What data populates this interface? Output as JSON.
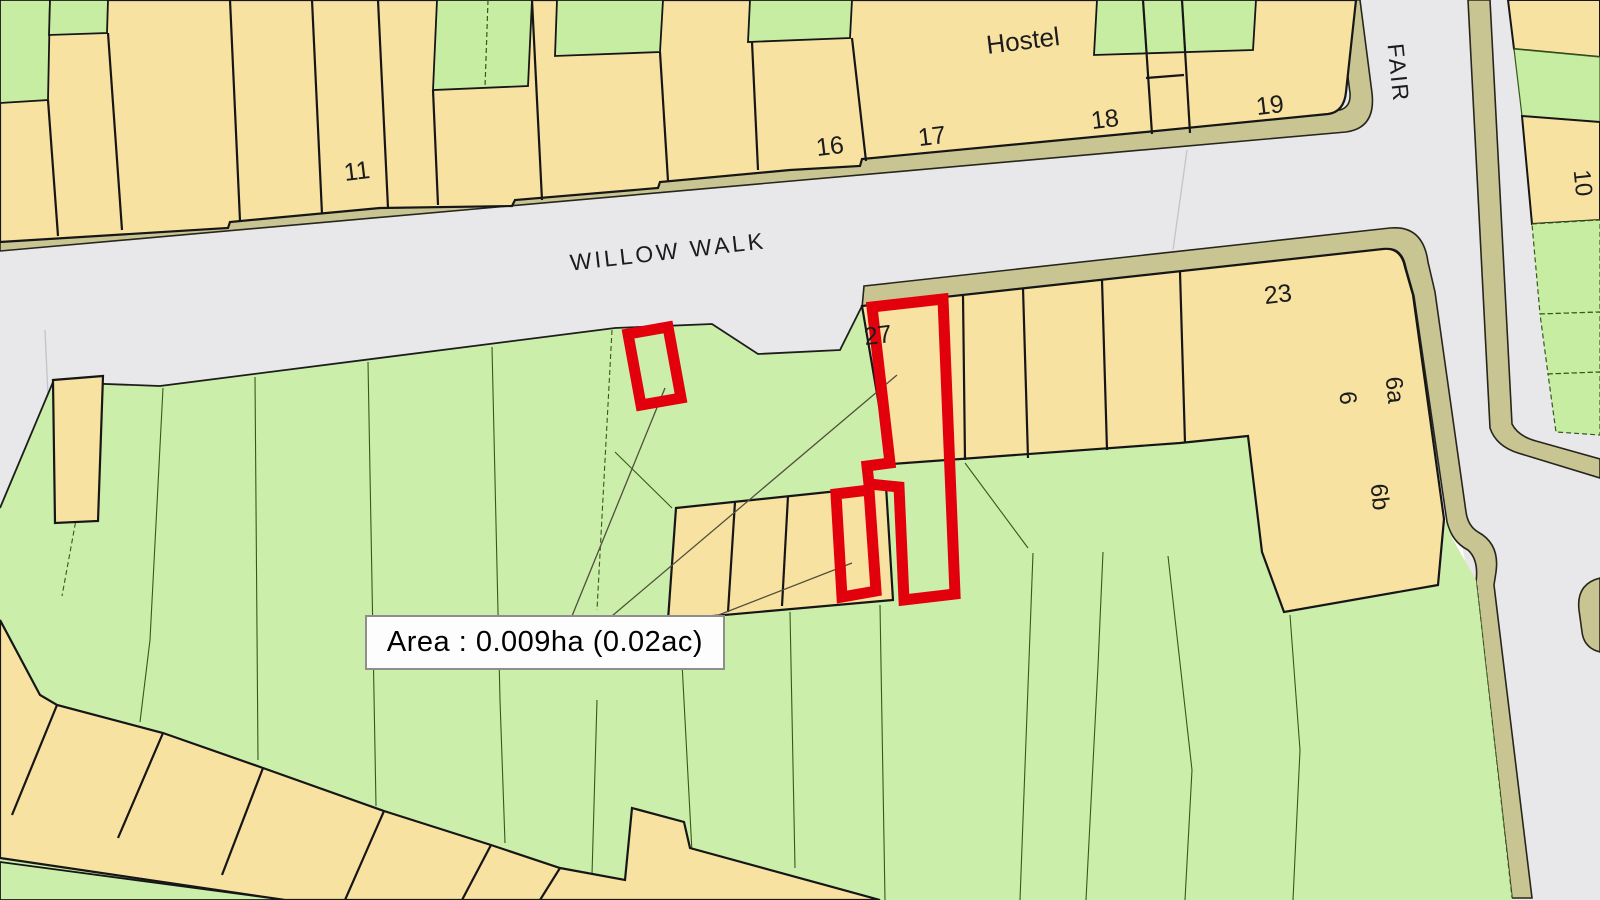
{
  "map": {
    "description": "Ordnance-survey style cadastral site plan",
    "streets": [
      {
        "name": "WILLOW WALK"
      },
      {
        "name": "FAIR"
      }
    ],
    "area_label": {
      "text": "Area : 0.009ha (0.02ac)"
    },
    "highlight": {
      "plot_number": "27",
      "outline_color": "#e2000c",
      "outlined_plots": 3
    },
    "colors": {
      "road": "#e8e8ea",
      "road_edge": "#c9c593",
      "building": "#f8e2a2",
      "plot_green": "#cbeeaa",
      "outline": "#161616",
      "plot_line": "#35591c",
      "highlight_red": "#e2000c",
      "label_box_bg": "#fdfdfd",
      "label_box_border": "#8e8e8e"
    },
    "labels": [
      {
        "name": "label-11",
        "text": "11",
        "x": 357,
        "y": 172,
        "size": 25,
        "rot": -7
      },
      {
        "name": "label-16",
        "text": "16",
        "x": 830,
        "y": 147,
        "size": 25,
        "rot": -7
      },
      {
        "name": "label-17",
        "text": "17",
        "x": 932,
        "y": 137,
        "size": 25,
        "rot": -7
      },
      {
        "name": "label-hostel",
        "text": "Hostel",
        "x": 1023,
        "y": 41,
        "size": 26,
        "rot": -7
      },
      {
        "name": "label-18",
        "text": "18",
        "x": 1105,
        "y": 120,
        "size": 25,
        "rot": -7
      },
      {
        "name": "label-19",
        "text": "19",
        "x": 1270,
        "y": 106,
        "size": 25,
        "rot": -7
      },
      {
        "name": "label-23",
        "text": "23",
        "x": 1278,
        "y": 295,
        "size": 25,
        "rot": -7
      },
      {
        "name": "label-27",
        "text": "27",
        "x": 878,
        "y": 336,
        "size": 25,
        "rot": -7
      },
      {
        "name": "label-6",
        "text": "6",
        "x": 1347,
        "y": 398,
        "size": 24,
        "rot": 84
      },
      {
        "name": "label-6a",
        "text": "6a",
        "x": 1394,
        "y": 390,
        "size": 24,
        "rot": 84
      },
      {
        "name": "label-6b",
        "text": "6b",
        "x": 1379,
        "y": 497,
        "size": 24,
        "rot": 84
      },
      {
        "name": "label-10",
        "text": "10",
        "x": 1582,
        "y": 183,
        "size": 24,
        "rot": 84
      },
      {
        "name": "street-willow-walk",
        "text": "WILLOW WALK",
        "x": 668,
        "y": 252,
        "size": 23,
        "rot": -6.5,
        "spacing": 3
      },
      {
        "name": "street-fair",
        "text": "FAIR",
        "x": 1398,
        "y": 73,
        "size": 23,
        "rot": 84,
        "spacing": 2
      }
    ]
  }
}
